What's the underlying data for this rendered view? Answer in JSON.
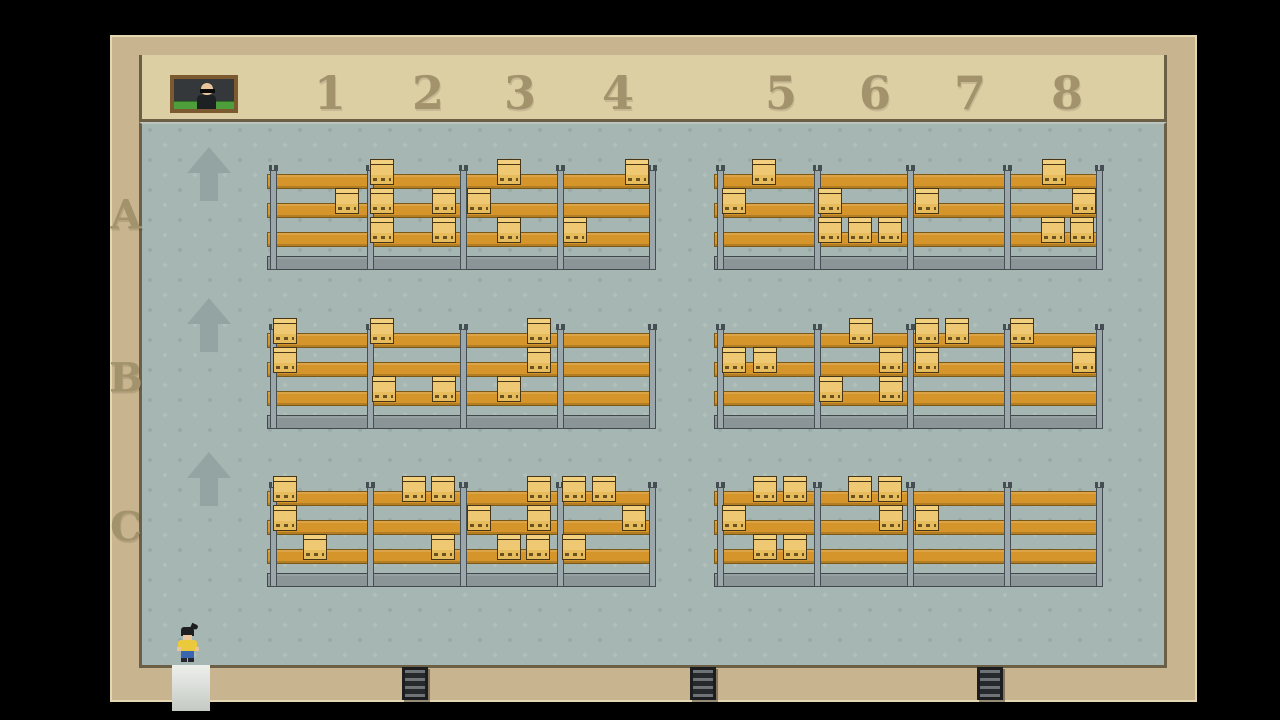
{
  "scene": "warehouse-storage-game",
  "header": {
    "column_labels": [
      {
        "label": "1",
        "x": 330
      },
      {
        "label": "2",
        "x": 428
      },
      {
        "label": "3",
        "x": 520
      },
      {
        "label": "4",
        "x": 618
      },
      {
        "label": "5",
        "x": 781
      },
      {
        "label": "6",
        "x": 875
      },
      {
        "label": "7",
        "x": 970
      },
      {
        "label": "8",
        "x": 1067
      }
    ]
  },
  "row_labels": [
    {
      "label": "A",
      "y": 215
    },
    {
      "label": "B",
      "y": 378
    },
    {
      "label": "C",
      "y": 527
    }
  ],
  "arrows": [
    {
      "x": 187,
      "y": 147
    },
    {
      "x": 187,
      "y": 298
    },
    {
      "x": 187,
      "y": 452
    }
  ],
  "shelf_geometry": {
    "levels": {
      "top": 0,
      "mid": 29,
      "bot": 58
    },
    "base_top": 82,
    "post_offsets": [
      3,
      100,
      193,
      290,
      382
    ],
    "box_width": 24,
    "box_height": 26
  },
  "shelf_units": [
    {
      "id": "A-left",
      "x": 267,
      "y": 174,
      "width": 389,
      "boxes": {
        "top": [
          103,
          230,
          358
        ],
        "mid": [
          68,
          103,
          165,
          200
        ],
        "bot": [
          103,
          165,
          230,
          296
        ]
      }
    },
    {
      "id": "A-right",
      "x": 714,
      "y": 174,
      "width": 389,
      "boxes": {
        "top": [
          38,
          328
        ],
        "mid": [
          8,
          104,
          201,
          358
        ],
        "bot": [
          104,
          134,
          164,
          327,
          356
        ]
      }
    },
    {
      "id": "B-left",
      "x": 267,
      "y": 333,
      "width": 389,
      "boxes": {
        "top": [
          6,
          103,
          260
        ],
        "mid": [
          6,
          260
        ],
        "bot": [
          105,
          165,
          230
        ]
      }
    },
    {
      "id": "B-right",
      "x": 714,
      "y": 333,
      "width": 389,
      "boxes": {
        "top": [
          135,
          201,
          231,
          296
        ],
        "mid": [
          8,
          39,
          165,
          201,
          358
        ],
        "bot": [
          105,
          165
        ]
      }
    },
    {
      "id": "C-left",
      "x": 267,
      "y": 491,
      "width": 389,
      "boxes": {
        "top": [
          6,
          135,
          164,
          260,
          295,
          325
        ],
        "mid": [
          6,
          200,
          260,
          355
        ],
        "bot": [
          36,
          164,
          230,
          259,
          295
        ]
      }
    },
    {
      "id": "C-right",
      "x": 714,
      "y": 491,
      "width": 389,
      "boxes": {
        "top": [
          39,
          69,
          134,
          164
        ],
        "mid": [
          8,
          165,
          201
        ],
        "bot": [
          39,
          69
        ]
      }
    }
  ],
  "doors": [
    {
      "x": 402
    },
    {
      "x": 690
    },
    {
      "x": 977
    }
  ],
  "exit": {
    "x": 172,
    "width": 38
  },
  "player": {
    "x": 177,
    "y": 627
  },
  "portrait": {
    "x": 170,
    "y": 75
  },
  "colors": {
    "background": "#000000",
    "wall": "#c8b48e",
    "wall-light": "#ddcfa4",
    "wall-line": "#6b6046",
    "wall-highlight": "#e4d8b2",
    "label": "#a2936d",
    "floor": "#a6b6b2",
    "floor-dot-light": "#b2c0bc",
    "floor-dot-dark": "#98a9a6",
    "floor-edge": "#bcc4be",
    "arrow": "#93a4a2",
    "shelf": "#d6952b",
    "shelf-dark": "#7a5916",
    "post": "#9ca7ab",
    "post-dark": "#454e53",
    "base": "#8b9598",
    "base-dark": "#40484c",
    "box-light": "#f2d07e",
    "box-main": "#eec873",
    "box-shade": "#e6bc5d",
    "box-line": "#463517",
    "box-dash": "#6b5120",
    "door-frame": "#1b1d1f",
    "door-dark": "#26292b",
    "door-stripe": "#6d7377",
    "exit-light": "#edefeb",
    "exit-shade": "#c5cac5",
    "player-hair": "#1e1e20",
    "player-skin": "#e9c59b",
    "player-shirt": "#eac93c",
    "player-pants": "#3a66b0",
    "player-shoes": "#23262e",
    "portrait-frame": "#7c5a30",
    "portrait-bg": "#34383a",
    "portrait-green": "#4f9e3c"
  }
}
